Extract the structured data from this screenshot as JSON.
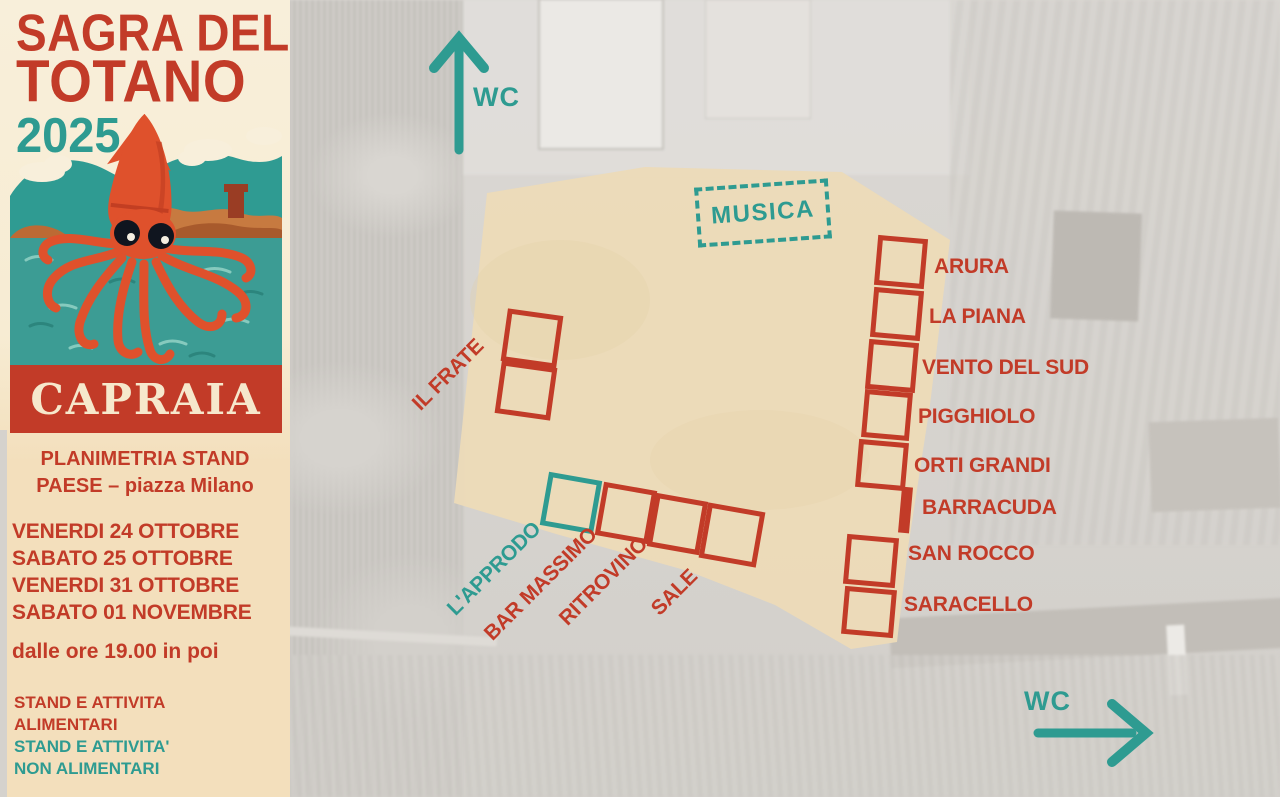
{
  "colors": {
    "accent_red": "#c23b28",
    "accent_teal": "#2e9b91",
    "panel_cream": "#f7ecd3",
    "piazza_beige": "#ecdbb8"
  },
  "sidebar": {
    "title_line1": "SAGRA DEL",
    "title_line2": "TOTANO",
    "year": "2025",
    "poster_place": "CAPRAIA",
    "subtitle_line1": "PLANIMETRIA STAND",
    "subtitle_line2": "PAESE – piazza Milano",
    "dates": [
      "VENERDI 24 OTTOBRE",
      "SABATO 25 OTTOBRE",
      "VENERDI 31 OTTOBRE",
      "SABATO 01 NOVEMBRE"
    ],
    "time_note": "dalle ore 19.00  in poi",
    "legend": [
      {
        "line1": "STAND E ATTIVITA",
        "line2": "ALIMENTARI",
        "color": "#c23b28",
        "meaning": "food stands"
      },
      {
        "line1": "STAND E ATTIVITA'",
        "line2": "NON ALIMENTARI",
        "color": "#2e9b91",
        "meaning": "non-food stands"
      }
    ]
  },
  "map": {
    "music_label": "MUSICA",
    "wc_top": {
      "label": "WC",
      "direction": "up"
    },
    "wc_bottom": {
      "label": "WC",
      "direction": "right"
    },
    "right_stands": [
      {
        "name": "ARURA",
        "marker": "box"
      },
      {
        "name": "LA PIANA",
        "marker": "box"
      },
      {
        "name": "VENTO DEL SUD",
        "marker": "box"
      },
      {
        "name": "PIGGHIOLO",
        "marker": "box"
      },
      {
        "name": "ORTI GRANDI",
        "marker": "box"
      },
      {
        "name": "BARRACUDA",
        "marker": "bar"
      },
      {
        "name": "SAN ROCCO",
        "marker": "box"
      },
      {
        "name": "SARACELLO",
        "marker": "box"
      }
    ],
    "left_stand": {
      "name": "IL FRATE",
      "marker": "double-box"
    },
    "bottom_stands": [
      {
        "name": "L'APPRODO",
        "type": "non-food"
      },
      {
        "name": "BAR MASSIMO",
        "type": "food"
      },
      {
        "name": "RITROVINO",
        "type": "food"
      },
      {
        "name": "SALE",
        "type": "food"
      }
    ]
  }
}
